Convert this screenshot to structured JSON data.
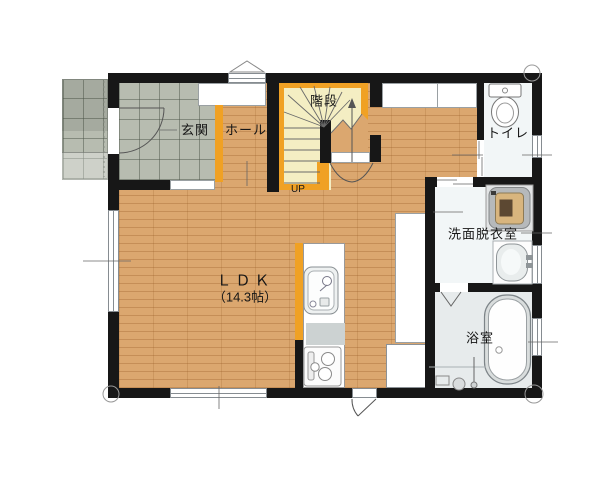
{
  "rooms": {
    "genkan": "玄関",
    "hall": "ホール",
    "stairs": "階段",
    "stairs_up": "UP",
    "toilet": "トイレ",
    "washroom": "洗面脱衣室",
    "bathroom": "浴室",
    "ldk": "ＬＤＫ",
    "ldk_area": "（14.3帖）"
  },
  "colors": {
    "wall": "#171717",
    "accent_wood": "#f0a124",
    "wood_floor": "#dba76f",
    "entrance_tile": "#b7bcb0",
    "stairs_floor": "#f4eec3",
    "wet_room_floor": "#f2f6f7",
    "bathroom_floor": "#e7ebec"
  }
}
